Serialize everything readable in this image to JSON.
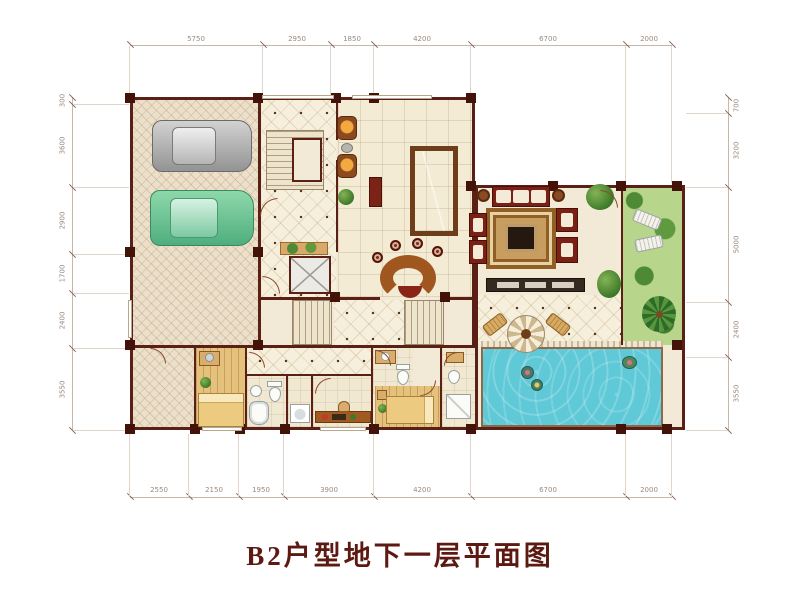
{
  "title": "B2户型地下一层平面图",
  "dimensions": {
    "top": [
      "5750",
      "2950",
      "1850",
      "4200",
      "6700",
      "2000"
    ],
    "bottom": [
      "2550",
      "2150",
      "1950",
      "3900",
      "4200",
      "6700",
      "2000"
    ],
    "left": [
      "300",
      "3600",
      "2900",
      "1700",
      "2400",
      "3550"
    ],
    "right": [
      "700",
      "3200",
      "5000",
      "2400",
      "3550"
    ]
  },
  "colors": {
    "title": "#5c1a12",
    "wall": "#5a2016",
    "pool": "#5fc9d7",
    "garden": "#b7d68b",
    "billiard_felt": "#3e8c3b",
    "carpet": "#c79e5f",
    "car_gray": "#a8a8a8",
    "car_green": "#69c492",
    "wood_floor": "#e5c27c",
    "garage_floor": "#ece0cb"
  }
}
